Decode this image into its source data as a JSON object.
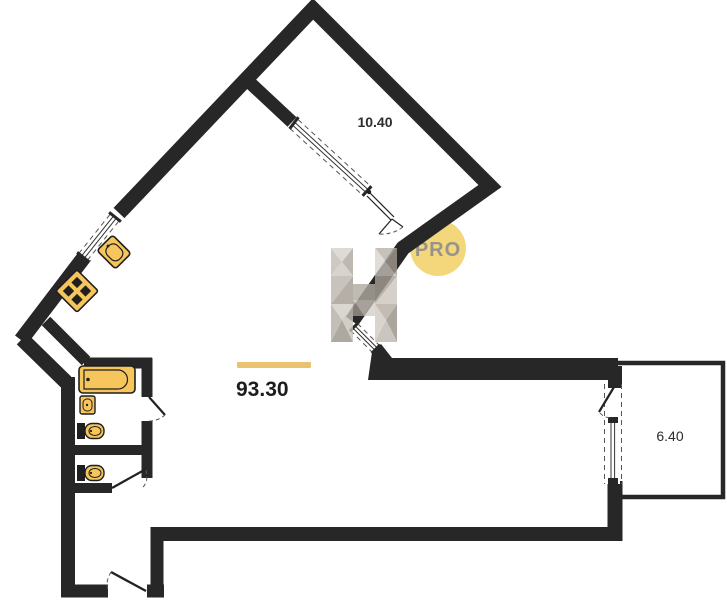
{
  "plan": {
    "rooms": [
      {
        "id": "bedroom",
        "area_label": "10.40"
      },
      {
        "id": "living",
        "area_label": "93.30"
      },
      {
        "id": "balcony",
        "area_label": "6.40"
      }
    ]
  },
  "watermark": {
    "badge_text": "PRO",
    "logo_letter": "H"
  },
  "colors": {
    "wall": "#272727",
    "fixture_fill": "#F6C55B",
    "fixture_stroke": "#1f1f1f",
    "accent_bar": "#E9C36E",
    "badge_circle": "#F5D77B",
    "badge_text": "#96948A",
    "dash_line": "#555555"
  }
}
